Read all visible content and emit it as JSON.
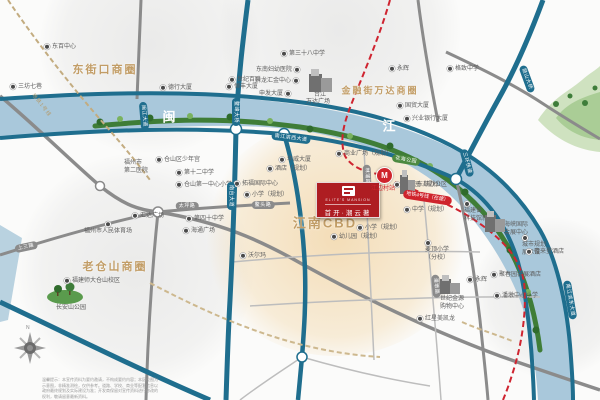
{
  "project": {
    "logo_en": "ELITE'S MANSION",
    "logo_cn": "首开·潮云著",
    "accent_red": "#ae1d22",
    "gold": "#c29d66",
    "teal_road": "#1f6e8e",
    "river_blue": "#a9c8db"
  },
  "zones": [
    {
      "t": "东街口商圈",
      "x": 105,
      "y": 69,
      "s": 11
    },
    {
      "t": "金融街万达商圈",
      "x": 380,
      "y": 90,
      "s": 9
    },
    {
      "t": "老仓山商圈",
      "x": 115,
      "y": 266,
      "s": 11
    },
    {
      "t": "江南CBD",
      "x": 325,
      "y": 222,
      "s": 13
    }
  ],
  "river": {
    "chars": [
      {
        "t": "闽",
        "x": 169,
        "y": 116
      },
      {
        "t": "江",
        "x": 389,
        "y": 125
      }
    ]
  },
  "metro": {
    "station": "江边村站",
    "badge": "地铁4号线（在建）",
    "line1": "地铁1号线",
    "pin_glyph": "M"
  },
  "road_labels": [
    {
      "t": "鳌峰大桥",
      "x": 236,
      "y": 112,
      "r": 90,
      "c": "teal"
    },
    {
      "t": "南台大道",
      "x": 231,
      "y": 196,
      "r": 90,
      "c": "teal"
    },
    {
      "t": "南江滨西大道",
      "x": 291,
      "y": 138,
      "r": 7,
      "c": "teal"
    },
    {
      "t": "闽江大道",
      "x": 144,
      "y": 116,
      "r": 85,
      "c": "teal"
    },
    {
      "t": "鼓山大桥",
      "x": 527,
      "y": 79,
      "r": 70,
      "c": "teal"
    },
    {
      "t": "三环快速",
      "x": 467,
      "y": 163,
      "r": 75,
      "c": "teal"
    },
    {
      "t": "南江滨东大道",
      "x": 570,
      "y": 300,
      "r": 80,
      "c": "teal"
    },
    {
      "t": "花海公园",
      "x": 406,
      "y": 160,
      "r": 10,
      "c": "green"
    },
    {
      "t": "太坪路",
      "x": 187,
      "y": 206,
      "r": 0,
      "c": "gray"
    },
    {
      "t": "鳌头路",
      "x": 263,
      "y": 205,
      "r": 0,
      "c": "gray"
    },
    {
      "t": "上三路",
      "x": 26,
      "y": 247,
      "r": -12,
      "c": "gray"
    },
    {
      "t": "林浦路",
      "x": 367,
      "y": 176,
      "r": 88,
      "c": "gray"
    },
    {
      "t": "潘墩路",
      "x": 436,
      "y": 286,
      "r": 85,
      "c": "gray"
    }
  ],
  "pois": [
    {
      "t": "东百中心",
      "x": 44,
      "y": 47,
      "d": "l"
    },
    {
      "t": "三坊七巷",
      "x": 10,
      "y": 87,
      "d": "l"
    },
    {
      "t": "德行大厦",
      "x": 160,
      "y": 88,
      "d": "l"
    },
    {
      "t": "第三十八中学",
      "x": 281,
      "y": 54,
      "d": "l"
    },
    {
      "t": "东南妇幼医院",
      "x": 256,
      "y": 70,
      "d": "r"
    },
    {
      "t": "世纪百联",
      "x": 229,
      "y": 80,
      "d": "l"
    },
    {
      "t": "升龙汇金中心",
      "x": 255,
      "y": 81,
      "d": "r"
    },
    {
      "t": "恒丰大厦",
      "x": 226,
      "y": 87,
      "d": "l"
    },
    {
      "t": "申发大厦",
      "x": 259,
      "y": 94,
      "d": "r"
    },
    {
      "t": "永辉",
      "x": 389,
      "y": 69,
      "d": "l"
    },
    {
      "t": "国贸大厦",
      "x": 397,
      "y": 106,
      "d": "l"
    },
    {
      "t": "兴业银行大厦",
      "x": 404,
      "y": 119,
      "d": "l"
    },
    {
      "t": "格致中学",
      "x": 447,
      "y": 69,
      "d": "l"
    },
    {
      "t": "台江",
      "x": 314,
      "y": 95,
      "d": "n"
    },
    {
      "t": "万达广场",
      "x": 306,
      "y": 102,
      "d": "n"
    },
    {
      "t": "福州市人民体育场",
      "x": 84,
      "y": 228,
      "d": "a"
    },
    {
      "t": "仓山区少年宫",
      "x": 156,
      "y": 160,
      "d": "l"
    },
    {
      "t": "第十二中学",
      "x": 176,
      "y": 173,
      "d": "l"
    },
    {
      "t": "仓山第一中心小学",
      "x": 176,
      "y": 185,
      "d": "l"
    },
    {
      "lines": [
        "福州市",
        "第二医院"
      ],
      "x": 124,
      "y": 160,
      "d": "n"
    },
    {
      "t": "汇达广场",
      "x": 132,
      "y": 216,
      "d": "l"
    },
    {
      "t": "第四十中学",
      "x": 186,
      "y": 219,
      "d": "l"
    },
    {
      "t": "海通广场",
      "x": 183,
      "y": 231,
      "d": "l"
    },
    {
      "t": "沃尔玛",
      "x": 240,
      "y": 256,
      "d": "l"
    },
    {
      "t": "福建师大仓山校区",
      "x": 64,
      "y": 281,
      "d": "l"
    },
    {
      "t": "长安山公园",
      "x": 56,
      "y": 308,
      "d": "n"
    },
    {
      "lines": [
        "麦顶小学",
        "（分校）"
      ],
      "x": 425,
      "y": 240,
      "d": "l"
    },
    {
      "lines": [
        "福建省",
        "科技馆新馆"
      ],
      "x": 464,
      "y": 201,
      "d": "l"
    },
    {
      "lines": [
        "海峡国际",
        "会展中心"
      ],
      "x": 504,
      "y": 222,
      "d": "n"
    },
    {
      "lines": [
        "城市规划",
        "展示馆"
      ],
      "x": 522,
      "y": 235,
      "d": "l"
    },
    {
      "t": "喜来登酒店",
      "x": 526,
      "y": 252,
      "d": "l"
    },
    {
      "t": "聚春园会展酒店",
      "x": 491,
      "y": 275,
      "d": "l"
    },
    {
      "t": "潘墩中心小学",
      "x": 494,
      "y": 296,
      "d": "l"
    },
    {
      "t": "永辉",
      "x": 467,
      "y": 280,
      "d": "l"
    },
    {
      "lines": [
        "世纪金源",
        "购物中心"
      ],
      "x": 440,
      "y": 296,
      "d": "n"
    },
    {
      "t": "红星美凯龙",
      "x": 417,
      "y": 319,
      "d": "l"
    },
    {
      "t": "华威大厦",
      "x": 279,
      "y": 160,
      "d": "l"
    },
    {
      "t": "商业广场（规划）",
      "x": 336,
      "y": 154,
      "d": "l"
    },
    {
      "t": "酒店（规划）",
      "x": 267,
      "y": 169,
      "d": "l"
    },
    {
      "t": "拓福国际中心",
      "x": 234,
      "y": 184,
      "d": "l"
    },
    {
      "t": "小学（规划）",
      "x": 244,
      "y": 195,
      "d": "l"
    },
    {
      "t": "幼儿园（规划）",
      "x": 394,
      "y": 185,
      "d": "l"
    },
    {
      "t": "中学（规划）",
      "x": 404,
      "y": 210,
      "d": "l"
    },
    {
      "t": "小学（规划）",
      "x": 357,
      "y": 228,
      "d": "l"
    },
    {
      "t": "幼儿园（规划）",
      "x": 331,
      "y": 237,
      "d": "l"
    },
    {
      "t": "东部办公区",
      "x": 417,
      "y": 185,
      "d": "n"
    }
  ],
  "buildings": [
    {
      "x": 309,
      "y": 69,
      "w": 23,
      "h": 23
    },
    {
      "x": 400,
      "y": 170,
      "w": 15,
      "h": 24
    },
    {
      "x": 485,
      "y": 211,
      "w": 20,
      "h": 21
    },
    {
      "x": 440,
      "y": 275,
      "w": 20,
      "h": 19
    }
  ],
  "compass": {
    "north": "N"
  },
  "disclaimer": {
    "lines": [
      "温馨提示：本宣传资料为要约邀请，不构成要约内容；本区位图为",
      "示意图，非精准测绘，仅供参考。道路、学校、商业等配套信息以",
      "政府最终规划及实际建设为准；开发商保留对宣传资料进行修改的",
      "权利，敬请留意最新资料。"
    ]
  }
}
